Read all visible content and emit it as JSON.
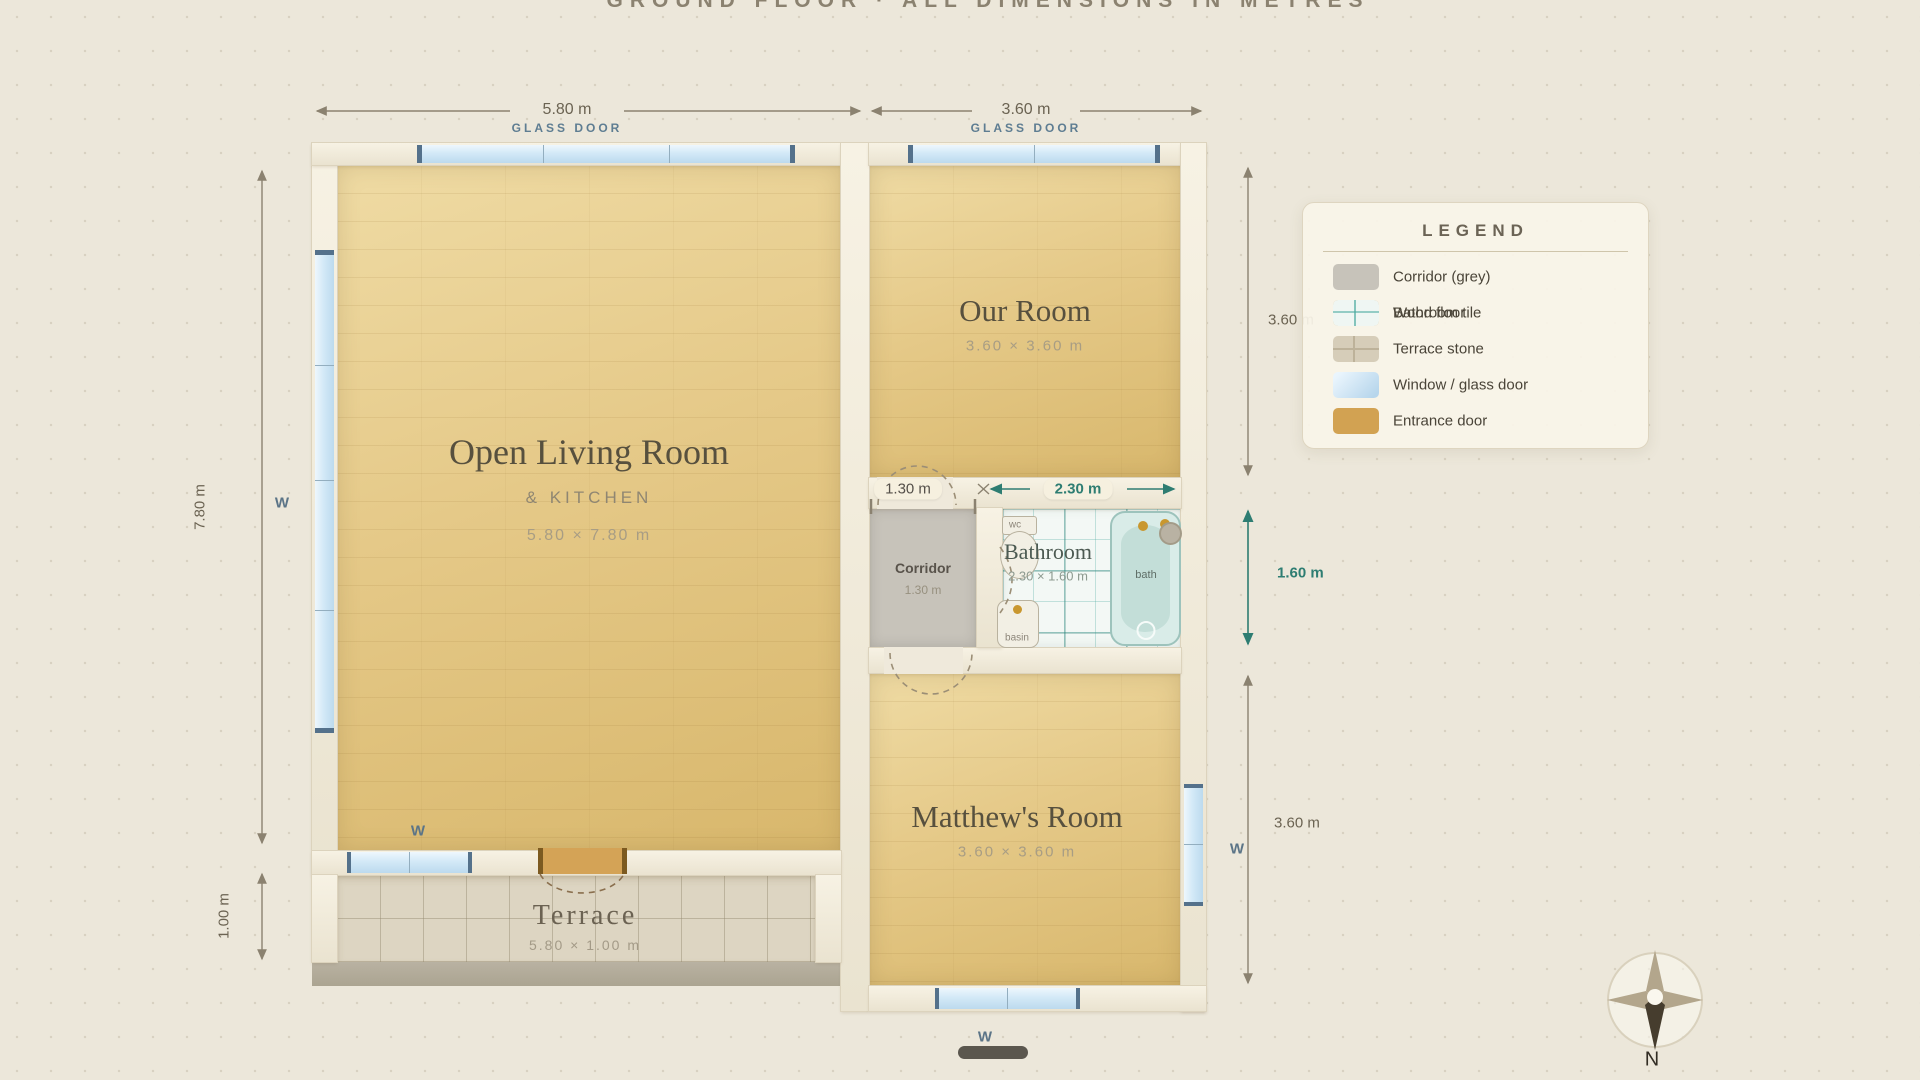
{
  "title": "GROUND FLOOR · ALL DIMENSIONS IN METRES",
  "rooms": {
    "living": {
      "name": "Open Living Room",
      "sub": "& KITCHEN",
      "dims": "5.80 × 7.80 m"
    },
    "our": {
      "name": "Our Room",
      "dims": "3.60 × 3.60 m"
    },
    "matthew": {
      "name": "Matthew's Room",
      "dims": "3.60 × 3.60 m"
    },
    "terrace": {
      "name": "Terrace",
      "dims": "5.80 × 1.00 m"
    },
    "bathroom": {
      "name": "Bathroom",
      "dims": "2.30 × 1.60 m"
    },
    "corridor": {
      "name": "Corridor",
      "dims": "1.30 m"
    }
  },
  "fixtures": {
    "wc": "wc",
    "basin": "basin",
    "bath": "bath"
  },
  "dims": {
    "top_left": "5.80 m",
    "top_right": "3.60 m",
    "glass_door": "GLASS DOOR",
    "left": "7.80 m",
    "terrace": "1.00 m",
    "right_top": "3.60 m",
    "right_mid": "1.60 m",
    "right_bottom": "3.60 m",
    "corridor_width": "1.30 m",
    "bathroom_width": "2.30 m"
  },
  "labels": {
    "window": "W",
    "north": "N"
  },
  "legend": {
    "title": "LEGEND",
    "items": [
      {
        "label": "Corridor (grey)",
        "swatch": "corridor-grey"
      },
      {
        "label": "Wood floor",
        "swatch": "wood-floor"
      },
      {
        "label": "Bathroom tile",
        "swatch": "bathroom-tile"
      },
      {
        "label": "Terrace stone",
        "swatch": "terrace-stone"
      },
      {
        "label": "Window / glass door",
        "swatch": "window-glass"
      },
      {
        "label": "Entrance door",
        "swatch": "entrance-door"
      }
    ]
  },
  "colors": {
    "accent_teal": "#2e7d72",
    "dim_brown": "#8b8270",
    "window_blue": "#5b7487",
    "entrance_tan": "#d2a252",
    "corridor_grey": "#c7c3ba"
  }
}
